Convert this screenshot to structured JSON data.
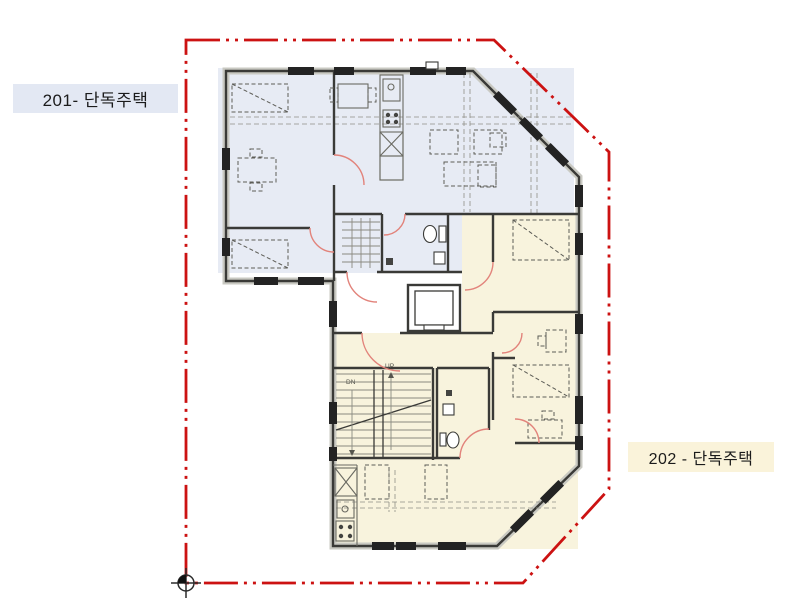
{
  "title": "Second floor plan with two dwelling units",
  "units": [
    {
      "id": "201",
      "label": "201- 단독주택",
      "tint": "#e7ebf4",
      "label_bg": "#e3e8f3"
    },
    {
      "id": "202",
      "label": "202 - 단독주택",
      "tint": "#f8f3dd",
      "label_bg": "#faf3da"
    }
  ],
  "stairs": {
    "up_label": "UP",
    "down_label": "DN"
  },
  "colors": {
    "boundary_red": "#cc1212",
    "wall_dark": "#3a3a37",
    "wall_light": "#c9c9c2",
    "door_swing": "#e2837b",
    "furniture": "#5c5c56",
    "window_dark": "#232323"
  }
}
